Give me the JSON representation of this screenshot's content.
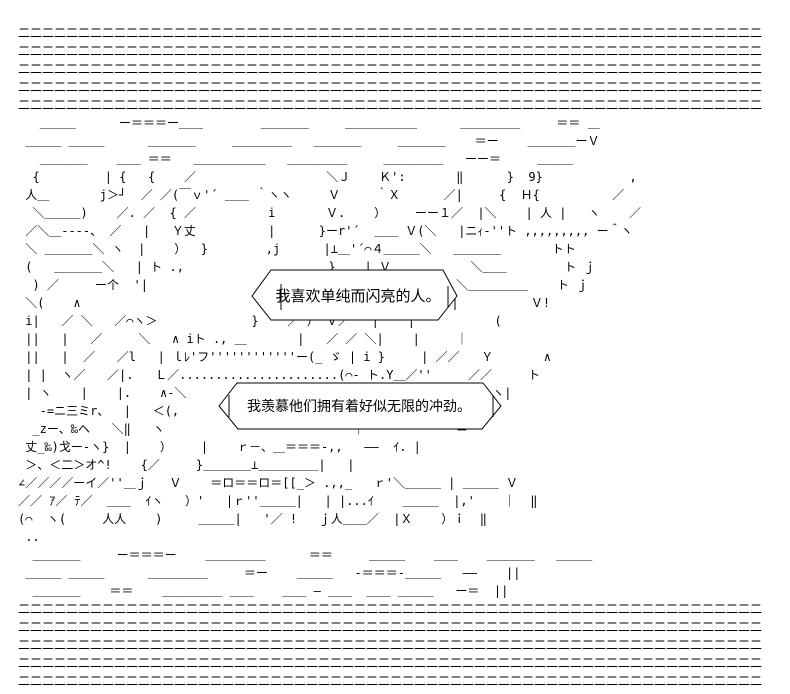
{
  "page": {
    "background_color": "#ffffff",
    "ink_color": "#000000"
  },
  "ascii_art": {
    "text": "二二二二二二二二二二二二二二二二二二二二二二二二二二二二二二二二二二二二二二二二二二二二二二二二二二二二二二二二二二二二二二\n二二二二二二二二二二二二二二二二二二二二二二二二二二二二二二二二二二二二二二二二二二二二二二二二二二二二二二二二二二二二二二\n二二二二二二二二二二二二二二二二二二二二二二二二二二二二二二二二二二二二二二二二二二二二二二二二二二二二二二二二二二二二二二\n二二二二二二二二二二二二二二二二二二二二二二二二二二二二二二二二二二二二二二二二二二二二二二二二二二二二二二二二二二二二二二\n二二二二二二二二二二二二二二二二二二二二二二二二二二二二二二二二二二二二二二二二二二二二二二二二二二二二二二二二二二二二二二\n   ＿＿＿      ー＝＝＝ー＿＿        ＿＿＿＿     ＿＿＿＿＿＿      ＿＿＿＿＿     ＝＝ ＿\n ＿＿＿ ＿＿＿      ＿＿＿＿     ＿＿＿＿＿   ＿＿＿＿     ＿＿＿＿    ＝ー    ＿＿＿＿ーＶ\n   ＿＿＿＿    ＿＿ ＝＝   ＿＿＿＿＿＿   ＿＿＿＿＿     ＿＿＿＿＿   ーー＝     ＿＿＿\n  {         | {   {    ／                  ＼Ｊ    Ｋ':       ‖      }  9}            ,\n 人＿       j＞┘  ／ ／(￣ｖ'´ ＿＿ ｀ヽヽ     Ｖ     ｀Ｘ      ／|     {  Ｈ{          ／\n  ＼＿＿＿)    ／. ／  { ／          i       Ｖ.    ）    ーー１／  |＼    | 人 |   ヽ    ／\n ／＼＿----、 ／   |   Ｙ丈          |      }ーr'´  ＿＿ Ｖ(＼   |ニｨ-''ト ,,,,,,,,, ー＾ヽ\n ＼ ＿＿＿＿＼ ヽ  |    ）  }        ,j      |⊥＿'´⌒４＿＿＿＼   ＿＿＿＿       トト\n (   ＿＿＿＿＼   | ト .,                    }    | Ｖ           ＼＿＿        ト ｊ\n  ) ／     ー个  '|                         |    | )Ｖ        ＼＿＿＿＿＿    ト ｊ\n ＼(    ∧                                 ／   ／ ∧ |    |   |          Ｖ!\n i|   ／ ＼   ／⌒ヽ＞             }    ／ ） Ｖ／   |    |           (\n ||   |   ／     ＼   ∧ iト ., ＿       |   ／ ／ ＼|    |     ｜\n ||   |  ／   ／l   | ｌﾚ'フ''''''''''''ー(_ ゞ | i }     | ／／   Ｙ       ∧\n | |  ヽ／   ／|.   Ｌ／......................(⌒- ト.Y＿／''     ／／     ト\n | ヽ    |    |.    ∧-＼                      ＼ .|      ／        ヽ|\n   -=ニ三ミr、  |   ＜(,                          ｜          ーｲ. |\n  _zー、‰ヘ   ＼‖   ヽ                          ｜           ｀＝\n 丈_‰)戈ー-ヽ}  |    ）    |    ｒ－、＿＝＝＝-,,   ――  ｲ. |\n ＞、＜二＞オ^!    {／     }＿＿＿＿⊥＿＿＿＿＿|   |\n∠／／／／ーイ／''＿ｊ   Ｖ    ＝ロ＝＝ロ＝[[_＞ .,,_   ｒ'＼＿＿＿ | ＿＿＿ Ｖ\n／／ ｱ／ ﾃ／  ＿＿  ｲヽ   ）'   |ｒ''＿＿＿|   | |...ｲ    ＿＿＿  |,'    ｜  ‖\n(⌒  ヽ(     人人    )     ＿＿＿|   '／ !   ｊ人＿＿／  |Ｘ    ）ｉ  ‖\n ..\n  ＿＿＿＿     ー＝＝＝ー    ＿＿＿＿＿      ＝＝     ＿＿＿    ＿＿    ＿＿＿＿   ＿＿＿\n ＿＿＿ ＿＿＿      ＿＿＿＿＿     ＝ー    ＿＿＿   -＝＝＝-＿＿＿   ――    ||\n  ＿＿＿＿    ＝＝    ＿＿＿＿＿ ＿＿    ＿＿ ― ＿＿  ＿＿ ＿＿＿   ー＝  ||\n二二二二二二二二二二二二二二二二二二二二二二二二二二二二二二二二二二二二二二二二二二二二二二二二二二二二二二二二二二二二二二\n二二二二二二二二二二二二二二二二二二二二二二二二二二二二二二二二二二二二二二二二二二二二二二二二二二二二二二二二二二二二二二\n二二二二二二二二二二二二二二二二二二二二二二二二二二二二二二二二二二二二二二二二二二二二二二二二二二二二二二二二二二二二二二\n二二二二二二二二二二二二二二二二二二二二二二二二二二二二二二二二二二二二二二二二二二二二二二二二二二二二二二二二二二二二二二\n二二二二二二二二二二二二二二二二二二二二二二二二二二二二二二二二二二二二二二二二二二二二二二二二二二二二二二二二二二二二二二"
  },
  "bubbles": [
    {
      "text": "我喜欢单纯而闪亮的人。"
    },
    {
      "text": "我羡慕他们拥有着好似无限的冲劲。"
    }
  ]
}
